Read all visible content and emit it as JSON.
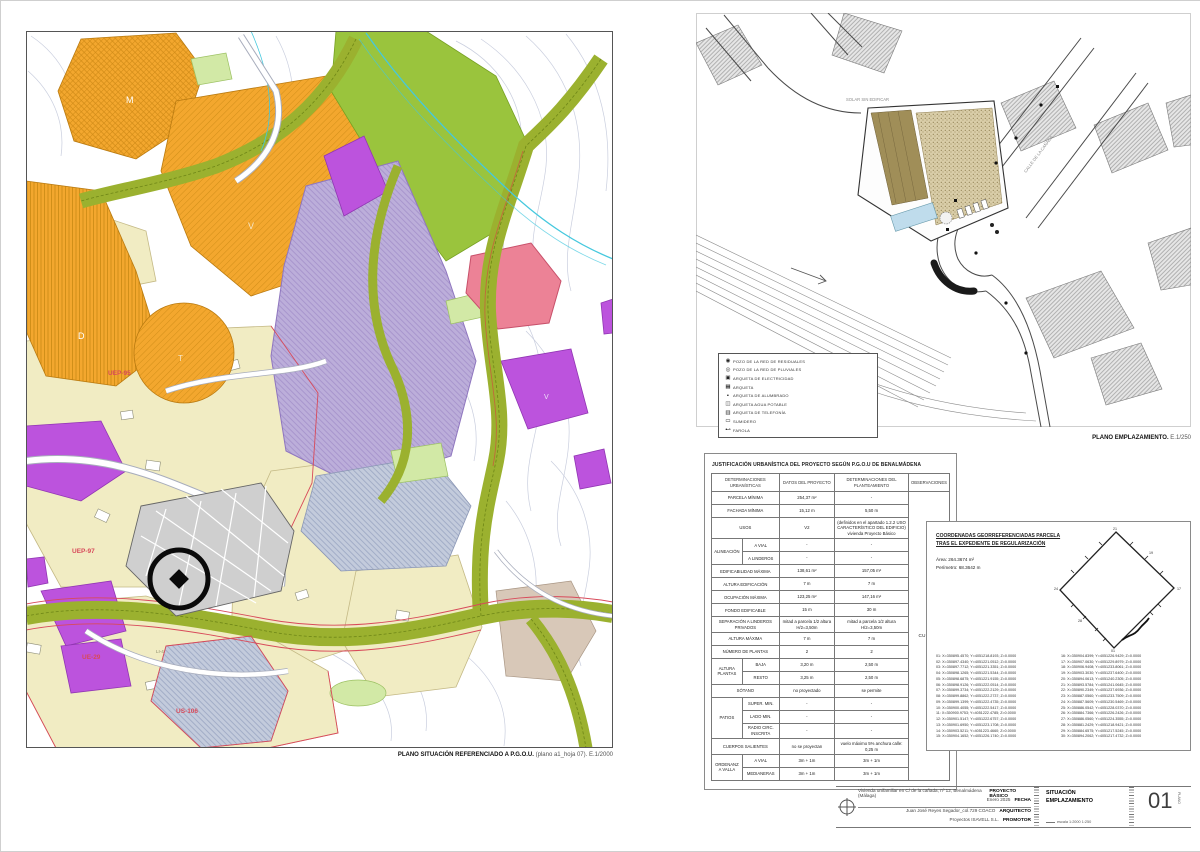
{
  "situacion_map": {
    "caption_bold": "PLANO SITUACIÓN REFERENCIADO A P.G.O.U.",
    "caption_rest": " (plano a1_hoja 07). E.1/2000",
    "labels": {
      "m": "M",
      "v": "V",
      "d": "D",
      "t": "T",
      "v2": "V",
      "uep95": "UEP-95",
      "uep97": "UEP-97",
      "ue29": "UE-29",
      "us106": "US-106",
      "li4": "LI-4"
    }
  },
  "emplazamiento": {
    "caption_bold": "PLANO EMPLAZAMIENTO.",
    "caption_rest": " E.1/250",
    "street_labels": {
      "main_road": "CALLE DE LA CAÑADA",
      "solar": "SOLAR SIN EDIFICAR"
    },
    "legend": {
      "items": [
        {
          "glyph": "◉",
          "label": "POZO DE LA RED DE RESIDUALES"
        },
        {
          "glyph": "◎",
          "label": "POZO DE LA RED DE PLUVIALES"
        },
        {
          "glyph": "▣",
          "label": "ARQUETA DE ELECTRICIDAD"
        },
        {
          "glyph": "▦",
          "label": "ARQUETA"
        },
        {
          "glyph": "▪",
          "label": "ARQUETA DE ALUMBRADO"
        },
        {
          "glyph": "◫",
          "label": "ARQUETA AGUA POTABLE"
        },
        {
          "glyph": "▥",
          "label": "ARQUETA DE TELEFONÍA"
        },
        {
          "glyph": "▭",
          "label": "SUMIDERO"
        },
        {
          "glyph": "⊷",
          "label": "FAROLA"
        }
      ]
    }
  },
  "justificacion": {
    "title": "JUSTIFICACIÓN URBANÍSTICA DEL PROYECTO SEGÚN P.G.O.U DE BENALMÁDENA",
    "headers": {
      "col1": "DETERMINACIONES URBANÍSTICAS",
      "col2": "DATOS DEL PROYECTO",
      "col3": "DETERMINACIONES DEL PLANTEAMIENTO",
      "col4": "OBSERVACIONES"
    },
    "observaciones_value": "CUMPLE",
    "rows": {
      "parcela": {
        "label": "PARCELA MÍNIMA",
        "proyecto": "254,37 m²",
        "plan": "-"
      },
      "fachada": {
        "label": "FACHADA MÍNIMA",
        "proyecto": "15,12 m",
        "plan": "5,50 m"
      },
      "usos": {
        "label": "USOS",
        "proyecto": "V2",
        "plan": "(definidos en el apartado 1.2.2 USO CARACTERÍSTICO DEL EDIFICIO) vivienda Proyecto Básico"
      },
      "alineacion": {
        "label": "ALINEACIÓN",
        "sub1": "A VIAL",
        "sub2": "A LINDEROS",
        "p1": "-",
        "pl1": "-",
        "p2": "-",
        "pl2": "-"
      },
      "edificabilidad": {
        "label": "EDIFICABILIDAD MÁXIMA",
        "proyecto": "138,61 m²",
        "plan": "157,05 m²"
      },
      "altura_edificacion": {
        "label": "ALTURA EDIFICACIÓN",
        "proyecto": "7 m",
        "plan": "7 m"
      },
      "ocupacion": {
        "label": "OCUPACIÓN MÁXIMA",
        "proyecto": "123,25 m²",
        "plan": "147,16 m²"
      },
      "fondo": {
        "label": "FONDO EDIFICABLE",
        "proyecto": "15 m",
        "plan": "30 m"
      },
      "separacion": {
        "label": "SEPARACIÓN A LINDEROS PRIVADOS",
        "proyecto": "mitad a parcela 1/2 altura H/2=3,50m",
        "plan": "mitad a parcela 1/2 altura H/2=3,50m"
      },
      "altura_maxima": {
        "label": "ALTURA MÁXIMA",
        "proyecto": "7 m",
        "plan": "7 m"
      },
      "num_plantas": {
        "label": "NÚMERO DE PLANTAS",
        "proyecto": "2",
        "plan": "2"
      },
      "altura_plantas": {
        "label": "ALTURA PLANTAS",
        "sub1": "BAJA",
        "sub2": "RESTO",
        "p1": "3,20 m",
        "pl1": "2,50 m",
        "p2": "3,25 m",
        "pl2": "2,50 m"
      },
      "sotano": {
        "label": "SÓTANO",
        "proyecto": "no proyectado",
        "plan": "se permite"
      },
      "patios": {
        "label": "PATIOS",
        "sub1": "SUPER. MIN.",
        "sub2": "LADO MIN.",
        "sub3": "RADIO CIRC. INSCRITA",
        "p1": "-",
        "pl1": "-",
        "p2": "-",
        "pl2": "-",
        "p3": "-",
        "pl3": "-"
      },
      "cuerpos": {
        "label": "CUERPOS SALIENTES",
        "proyecto": "no se proyectan",
        "plan": "vuelo máximo 5% anchura calle: 0,25 m"
      },
      "ordenanza": {
        "label": "ORDENANZA VALLA",
        "sub1": "A VIAL",
        "sub2": "MEDIANERAS",
        "p1": "3m + 1m",
        "pl1": "3m + 1m",
        "p2": "3m + 1m",
        "pl2": "3m + 1m"
      }
    }
  },
  "coordenadas": {
    "title1": "COORDENADAS GEORREFERENCIADAS PARCELA",
    "title2": "TRAS EL EXPEDIENTE DE REGULARIZACIÓN",
    "area_label": "Área:",
    "area_value": "264.3674 m²",
    "perimetro_label": "Perímetro:",
    "perimetro_value": "68.3642 m",
    "diagram_labels": {
      "top": "21",
      "right": "17",
      "bottom": "01",
      "left": "24",
      "ne": "19",
      "sw": "28"
    },
    "points_col1": [
      "01: X=350895.4570; Y=4051218.8193; Z=0.0000",
      "02: X=350897.4340; Y=4051221.0512; Z=0.0000",
      "03: X=350897.7712; Y=4051221.3351; Z=0.0000",
      "04: X=350898.1265; Y=4051221.5344; Z=0.0000",
      "05: X=350898.6875; Y=4051221.9155; Z=0.0000",
      "06: X=350898.9126; Y=4051222.0514; Z=0.0000",
      "07: X=350899.3734; Y=4051222.2129; Z=0.0000",
      "08: X=350899.8862; Y=4051222.2737; Z=0.0000",
      "09: X=350899.1399; Y=4051222.4735; Z=0.0000",
      "10: X=350900.4055; Y=4051222.5417; Z=0.0000",
      "11: X=350900.9753; Y=4051222.4785; Z=0.0000",
      "12: X=350901.5147; Y=4051222.6757; Z=0.0000",
      "13: X=350901.6950; Y=4051223.1708; Z=0.0000",
      "14: X=350903.5211; Y=4051223.4660; Z=0.0000",
      "15: X=350904.1652; Y=4051226.1740; Z=0.0000"
    ],
    "points_col2": [
      "16: X=350904.8399; Y=4051226.9429; Z=0.0000",
      "17: X=350907.0630; Y=4051229.8979; Z=0.0000",
      "18: X=350906.9408; Y=4051233.8061; Z=0.0000",
      "19: X=350903.3030; Y=4051237.6400; Z=0.0000",
      "20: X=350894.0613; Y=4051240.2305; Z=0.0000",
      "21: X=350893.5784; Y=4051241.0645; Z=0.0000",
      "22: X=350890.2349; Y=4051237.6936; Z=0.0000",
      "23: X=350887.0560; Y=4051233.7509; Z=0.0000",
      "24: X=350887.5609; Y=4051230.5469; Z=0.0000",
      "25: X=350886.0542; Y=4051228.0370; Z=0.0000",
      "26: X=350884.7366; Y=4051226.2426; Z=0.0000",
      "27: X=350886.0560; Y=4051224.3555; Z=0.0000",
      "28: X=350881.2429; Y=4051218.9421; Z=0.0000",
      "29: X=350884.6575; Y=4051217.5245; Z=0.0000",
      "30: X=350894.2062; Y=4051217.4732; Z=0.0000"
    ]
  },
  "titleblock": {
    "rows": [
      {
        "value": "Vivienda unifamiliar en C/ de la cañada, nº 12, Benalmádena (Málaga)",
        "key": "PROYECTO BÁSICO"
      },
      {
        "value": "Enero 2025",
        "key": "FECHA"
      },
      {
        "value": "Juan José Reyes Segador_col.729 COACO",
        "key": "ARQUITECTO"
      },
      {
        "value": "Proyectos ISAVELL S.L.",
        "key": "PROMOTOR"
      }
    ],
    "sheet_title1": "SITUACIÓN",
    "sheet_title2": "EMPLAZAMIENTO",
    "scale": "escala 1:2000  1:250",
    "sheet_number": "01",
    "sheet_number_caption": "PLANO"
  },
  "colors": {
    "orange_zone": "#f3a72e",
    "olive_corridor": "#9bb12f",
    "bright_green": "#9ac43d",
    "lavender_zone": "#bcaeda",
    "purple_zone": "#bc53dd",
    "cream_zone": "#f1ecc3",
    "pink_zone": "#ec8296",
    "bluegray_zone": "#c3cbdc",
    "red_boundary": "#d84a5a",
    "cyan_stream": "#45c8de"
  }
}
